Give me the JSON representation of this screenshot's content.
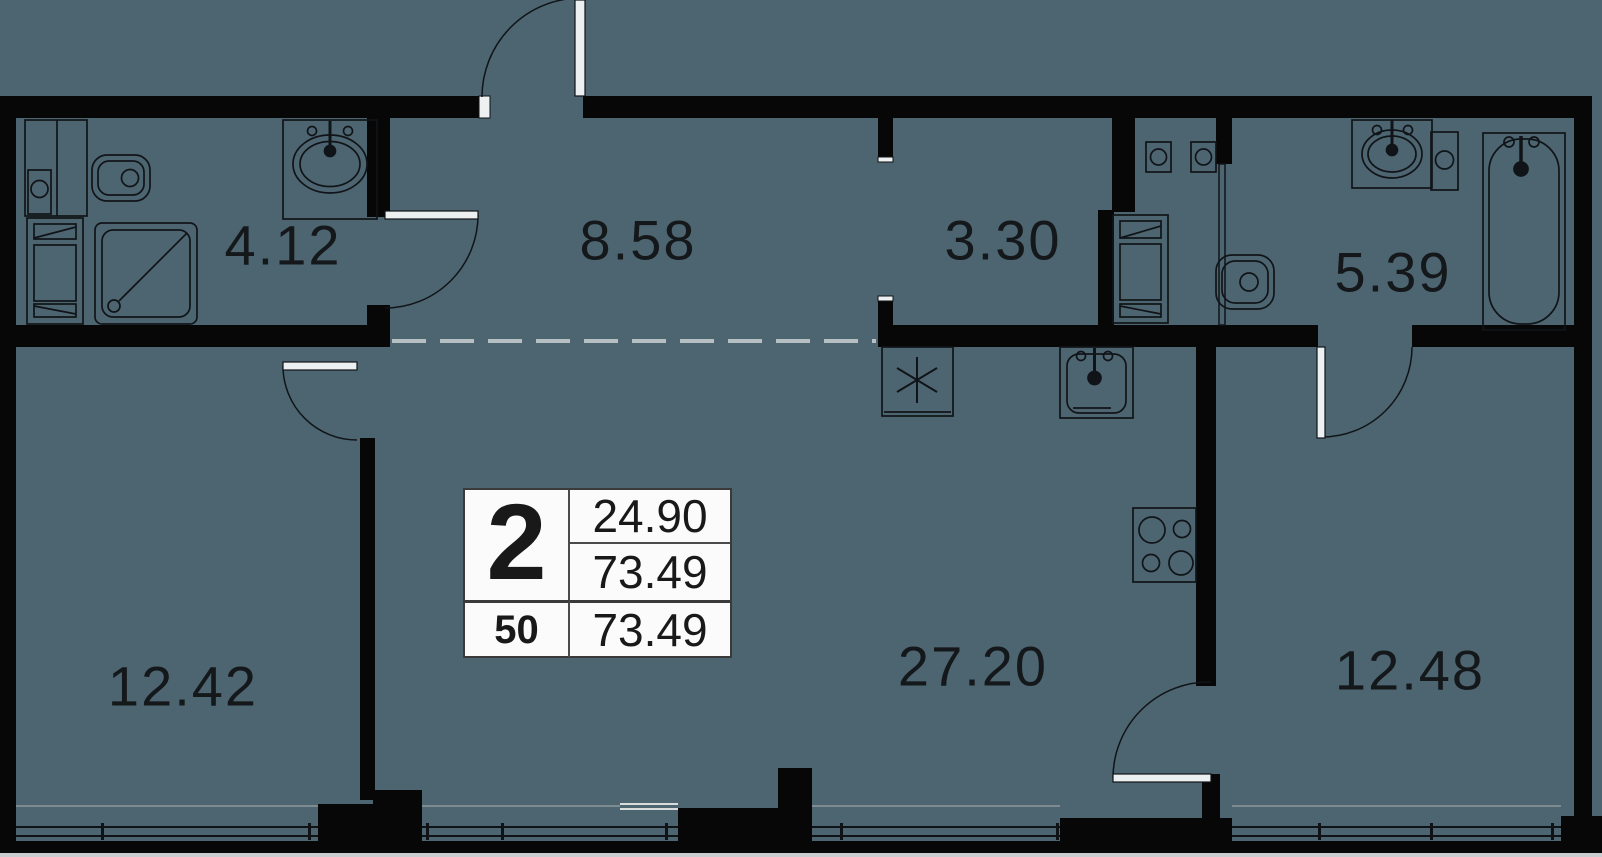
{
  "plan": {
    "background_color": "#4d6570",
    "wall_color": "#070708",
    "line_color": "#101418",
    "rooms": [
      {
        "id": "bathroom-small",
        "area": "4.12"
      },
      {
        "id": "hallway",
        "area": "8.58"
      },
      {
        "id": "wardrobe",
        "area": "3.30"
      },
      {
        "id": "bathroom-large",
        "area": "5.39"
      },
      {
        "id": "bedroom-left",
        "area": "12.42"
      },
      {
        "id": "kitchen-living",
        "area": "27.20"
      },
      {
        "id": "bedroom-right",
        "area": "12.48"
      }
    ],
    "unit_card": {
      "rooms_count": "2",
      "living_area": "24.90",
      "total_area": "73.49",
      "unit_number": "50",
      "total_area_repeat": "73.49"
    },
    "fixtures": [
      "toilet",
      "shower",
      "sink",
      "washer",
      "appliance-column",
      "bathtub",
      "kitchen-sink",
      "stove",
      "fridge"
    ]
  }
}
